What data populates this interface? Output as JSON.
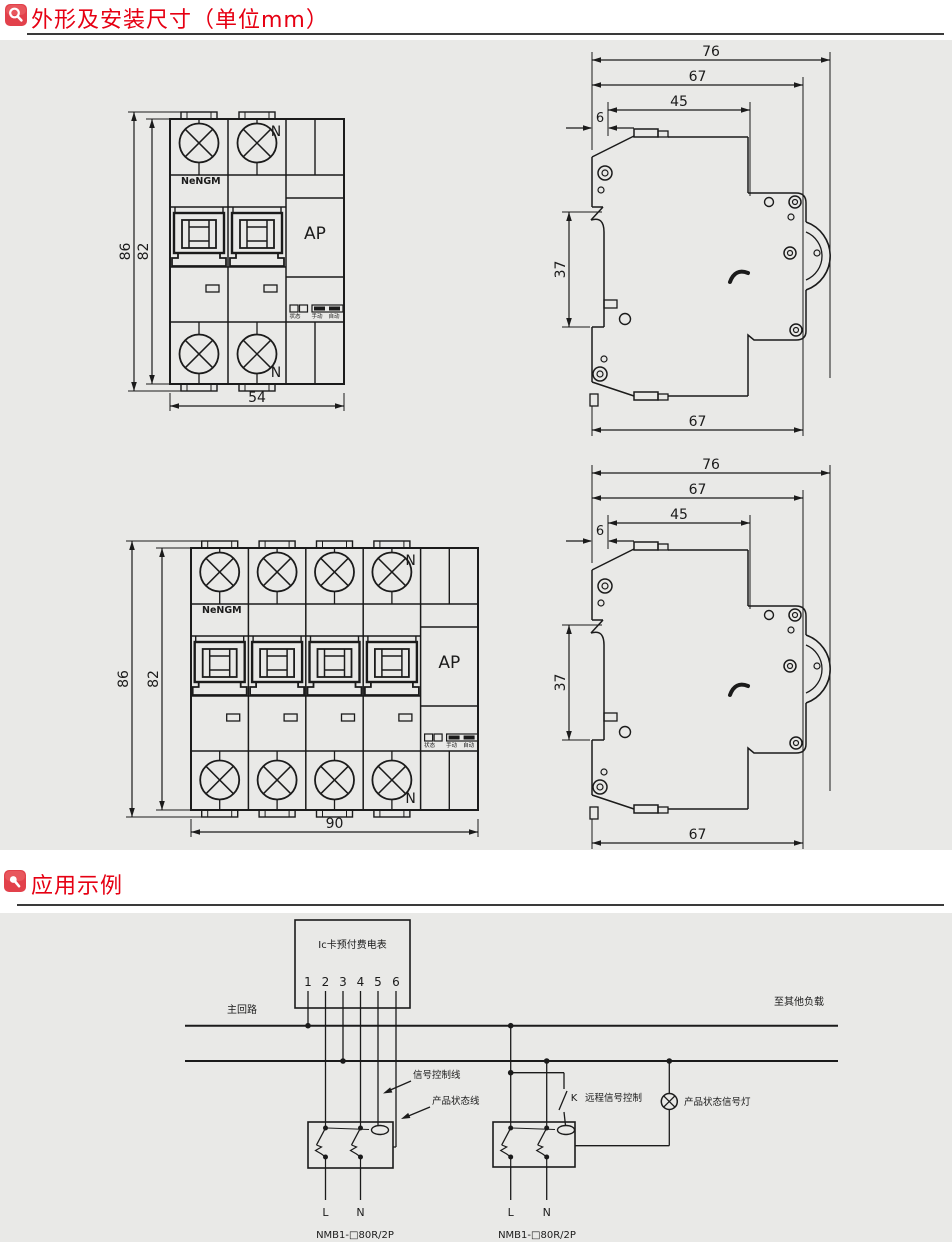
{
  "page": {
    "background": "#ffffff",
    "panel_background": "#e9e9e7",
    "line_color": "#1b1b1b",
    "accent_red": "#e60013",
    "icon_red": "#e2414b"
  },
  "section1": {
    "title": "外形及安装尺寸（单位mm）"
  },
  "section2": {
    "title": "应用示例"
  },
  "front_view": {
    "brand": "NeNGM",
    "module_label": "AP",
    "neutral_label": "N",
    "indicator_labels": [
      "状态",
      "手动",
      "自动"
    ],
    "views": [
      {
        "name": "2-pole front view",
        "dim_outer_height": "86",
        "dim_body_height": "82",
        "dim_width": "54"
      },
      {
        "name": "4-pole front view",
        "dim_outer_height": "86",
        "dim_body_height": "82",
        "dim_width": "90"
      }
    ]
  },
  "side_view": {
    "dim_top_width": "76",
    "dim_mid_width": "67",
    "dim_inner_width": "45",
    "dim_offset": "6",
    "dim_rail_height": "37",
    "dim_bottom_width": "67"
  },
  "wiring": {
    "meter_label": "Ic卡预付费电表",
    "terminals": [
      "1",
      "2",
      "3",
      "4",
      "5",
      "6"
    ],
    "main_circuit": "主回路",
    "to_other_loads": "至其他负载",
    "signal_control_line": "信号控制线",
    "product_status_line": "产品状态线",
    "switch_label": "K",
    "remote_signal_control": "远程信号控制",
    "product_status_lamp": "产品状态信号灯",
    "phase_label": "L",
    "neutral_label": "N",
    "breaker_model": "NMB1-□80R/2P"
  }
}
